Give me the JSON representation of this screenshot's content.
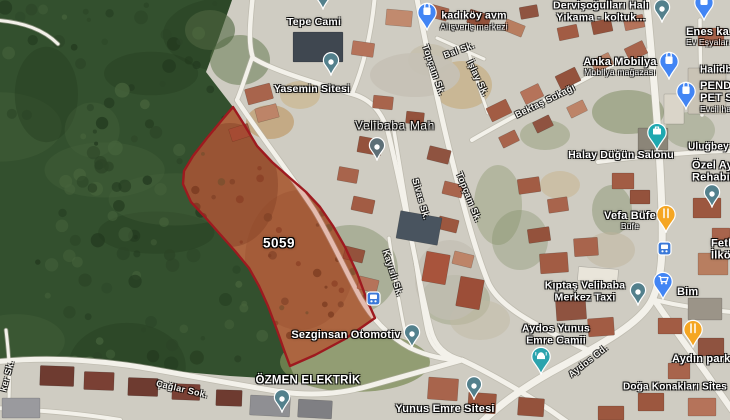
{
  "map": {
    "parcel": {
      "id_label": "5059",
      "outline_color": "#9e1a1f",
      "fill_color": "rgba(190,45,22,0.28)",
      "dirt_color": "#a57a51",
      "points": "233,107 222,120 207,138 193,156 184,171 183,184 191,202 204,216 219,233 235,251 249,268 259,286 268,306 277,330 284,350 290,366 315,355 345,339 375,318 367,300 357,273 345,247 333,226 320,207 306,192 290,178 272,162 257,146 245,126"
    },
    "colors": {
      "urban": "#cfccc2",
      "forest": "#33502e",
      "forest_dark": "#22381e",
      "forest_light": "#47643c",
      "road": "#f3f1ea",
      "road_casing": "#b3afa3"
    },
    "forest_points": "0,0 232,0 218,40 206,72 233,107 222,120 207,138 193,156 184,171 183,184 191,202 204,216 219,233 235,251 249,268 259,286 268,306 277,330 284,350 290,366 296,380 230,376 160,370 90,361 30,359 0,361",
    "roads": [
      {
        "d": "M646,-6 C652,60 660,140 662,215 C663,258 661,280 653,298 C643,322 602,344 562,366 C532,382 502,402 480,424",
        "w": 7
      },
      {
        "d": "M653,298 C668,320 688,348 704,370 C714,384 722,396 732,410",
        "w": 6
      },
      {
        "d": "M416,-6 C426,45 438,105 452,160 C464,208 475,250 488,282 C498,305 530,322 562,338 C576,345 588,350 598,355",
        "w": 5
      },
      {
        "d": "M253,-6 C250,22 248,44 253,58 C272,70 312,82 352,94 C371,99 382,112 388,132 C394,155 402,195 410,232 C416,262 423,300 431,330 C435,346 446,356 462,360",
        "w": 4.5
      },
      {
        "d": "M375,-6 C372,30 364,65 352,94",
        "w": 4
      },
      {
        "d": "M237,100 C260,135 289,172 314,210 C331,238 347,274 361,299 C371,317 388,336 410,348 C427,356 446,360 462,360",
        "w": 4.5
      },
      {
        "d": "M237,100 C242,88 247,72 252,58",
        "w": 4
      },
      {
        "d": "M393,125 C400,165 406,205 413,245 C417,272 421,300 427,330 C430,344 438,354 450,358",
        "w": 3.5
      },
      {
        "d": "M389,238 C394,272 399,305 406,336",
        "w": 3
      },
      {
        "d": "M472,140 C510,118 554,95 598,72 C618,62 636,54 652,49",
        "w": 4
      },
      {
        "d": "M437,38 C453,45 468,52 484,59",
        "w": 3
      },
      {
        "d": "M467,46 C473,68 480,91 488,113",
        "w": 3
      },
      {
        "d": "M-6,362 C40,357 90,359 140,367 C182,374 232,384 282,392 C312,396 341,394 369,386 C402,377 433,368 462,360",
        "w": 5
      },
      {
        "d": "M462,360 C492,374 522,392 550,410 C560,417 570,424 578,430",
        "w": 5
      },
      {
        "d": "M598,162 C628,158 658,155 688,153 C702,152 716,151 732,151",
        "w": 4
      },
      {
        "d": "M655,300 C680,306 706,310 732,312",
        "w": 4
      },
      {
        "d": "M-6,20 C24,22 44,30 58,44",
        "w": 3
      },
      {
        "d": "M-6,408 C40,410 84,414 120,420",
        "w": 4
      },
      {
        "d": "M700,20 C700,50 701,85 702,115",
        "w": 3.5
      },
      {
        "d": "M6,330 C9,355 11,380 8,412",
        "w": 3
      }
    ],
    "green_patches": [
      [
        355,
        362,
        75,
        30,
        "#7e8d58",
        0.75
      ],
      [
        350,
        270,
        48,
        45,
        "#74845a",
        0.4
      ],
      [
        300,
        300,
        30,
        40,
        "#6d7f52",
        0.45
      ],
      [
        498,
        205,
        24,
        40,
        "#7d8c5e",
        0.35
      ],
      [
        628,
        112,
        36,
        22,
        "#6f8152",
        0.45
      ],
      [
        545,
        135,
        25,
        15,
        "#78885a",
        0.35
      ],
      [
        455,
        300,
        35,
        25,
        "#7d8c5e",
        0.3
      ],
      [
        520,
        240,
        28,
        30,
        "#74845a",
        0.3
      ],
      [
        612,
        210,
        20,
        25,
        "#6d7f52",
        0.35
      ],
      [
        690,
        130,
        25,
        18,
        "#74845a",
        0.3
      ],
      [
        240,
        60,
        30,
        25,
        "#5d7347",
        0.5
      ],
      [
        210,
        30,
        25,
        20,
        "#4e6540",
        0.6
      ]
    ],
    "dirt_patches": [
      [
        462,
        85,
        30,
        24,
        "#c7b28a",
        0.8
      ],
      [
        270,
        122,
        24,
        17,
        "#c2a67e",
        0.9
      ],
      [
        300,
        95,
        20,
        14,
        "#cbb78f",
        0.7
      ],
      [
        430,
        60,
        22,
        16,
        "#c2b9a4",
        0.6
      ],
      [
        560,
        185,
        20,
        14,
        "#c7b28a",
        0.5
      ],
      [
        610,
        250,
        25,
        18,
        "#bfb49c",
        0.5
      ],
      [
        480,
        320,
        30,
        20,
        "#c2b9a4",
        0.5
      ],
      [
        415,
        75,
        45,
        22,
        "#c5c1b6",
        0.9
      ],
      [
        450,
        280,
        35,
        40,
        "#c2beb2",
        0.7
      ]
    ],
    "buildings": [
      [
        293,
        32,
        50,
        30,
        "#3f4750",
        0
      ],
      [
        246,
        86,
        26,
        16,
        "#a8644c",
        -15
      ],
      [
        256,
        106,
        22,
        14,
        "#bd8468",
        -15
      ],
      [
        230,
        126,
        20,
        13,
        "#9c573f",
        -18
      ],
      [
        352,
        42,
        22,
        14,
        "#b5735a",
        8
      ],
      [
        386,
        10,
        26,
        16,
        "#c18a6e",
        5
      ],
      [
        428,
        6,
        20,
        13,
        "#a8644c",
        15
      ],
      [
        468,
        12,
        22,
        14,
        "#94523c",
        18
      ],
      [
        504,
        22,
        20,
        12,
        "#b87e60",
        22
      ],
      [
        520,
        6,
        18,
        12,
        "#8f5340",
        -10
      ],
      [
        558,
        26,
        20,
        13,
        "#a25c44",
        -12
      ],
      [
        592,
        20,
        20,
        13,
        "#94523c",
        -12
      ],
      [
        624,
        16,
        20,
        13,
        "#b5735a",
        -12
      ],
      [
        488,
        103,
        22,
        15,
        "#a25c44",
        -26
      ],
      [
        522,
        87,
        20,
        14,
        "#b5735a",
        -26
      ],
      [
        557,
        71,
        22,
        15,
        "#94523c",
        -26
      ],
      [
        592,
        56,
        20,
        13,
        "#bd8468",
        -26
      ],
      [
        626,
        44,
        20,
        14,
        "#a8644c",
        -26
      ],
      [
        500,
        133,
        18,
        12,
        "#a8644c",
        -26
      ],
      [
        534,
        118,
        18,
        12,
        "#8f5340",
        -26
      ],
      [
        568,
        103,
        18,
        12,
        "#bd8468",
        -26
      ],
      [
        358,
        138,
        24,
        16,
        "#94523c",
        10
      ],
      [
        338,
        168,
        20,
        14,
        "#a8644c",
        10
      ],
      [
        352,
        198,
        22,
        14,
        "#a25c44",
        12
      ],
      [
        344,
        248,
        20,
        13,
        "#94523c",
        14
      ],
      [
        358,
        278,
        20,
        13,
        "#b5735a",
        14
      ],
      [
        428,
        148,
        22,
        14,
        "#8f5340",
        14
      ],
      [
        443,
        183,
        20,
        13,
        "#a8644c",
        14
      ],
      [
        438,
        218,
        20,
        13,
        "#9c573f",
        14
      ],
      [
        453,
        253,
        20,
        13,
        "#bd8468",
        14
      ],
      [
        398,
        214,
        42,
        28,
        "#49545f",
        10
      ],
      [
        518,
        178,
        22,
        15,
        "#a25c44",
        -8
      ],
      [
        548,
        198,
        20,
        14,
        "#a8644c",
        -8
      ],
      [
        528,
        228,
        22,
        14,
        "#94523c",
        -8
      ],
      [
        540,
        253,
        28,
        20,
        "#a25c44",
        -4
      ],
      [
        574,
        238,
        24,
        18,
        "#a8644c",
        -4
      ],
      [
        578,
        268,
        40,
        14,
        "#e9e5da",
        4
      ],
      [
        688,
        68,
        38,
        46,
        "#c9c3b5",
        0
      ],
      [
        664,
        94,
        20,
        30,
        "#dad5c9",
        0
      ],
      [
        698,
        28,
        26,
        18,
        "#a8644c",
        0
      ],
      [
        638,
        128,
        30,
        22,
        "#8b8578",
        0
      ],
      [
        612,
        173,
        22,
        16,
        "#a25c44",
        0
      ],
      [
        630,
        190,
        20,
        14,
        "#94523c",
        0
      ],
      [
        693,
        198,
        28,
        20,
        "#9c573f",
        0
      ],
      [
        712,
        228,
        18,
        14,
        "#a8644c",
        0
      ],
      [
        698,
        253,
        30,
        22,
        "#b87e60",
        0
      ],
      [
        688,
        298,
        34,
        22,
        "#9b9488",
        0
      ],
      [
        658,
        318,
        24,
        16,
        "#a25c44",
        0
      ],
      [
        698,
        338,
        26,
        18,
        "#8f5340",
        0
      ],
      [
        668,
        363,
        22,
        16,
        "#a8644c",
        0
      ],
      [
        638,
        393,
        26,
        18,
        "#9c573f",
        0
      ],
      [
        688,
        398,
        28,
        18,
        "#b5735a",
        0
      ],
      [
        556,
        298,
        30,
        22,
        "#8f5340",
        -4
      ],
      [
        588,
        318,
        26,
        18,
        "#a25c44",
        -4
      ],
      [
        424,
        253,
        24,
        30,
        "#a8543c",
        10
      ],
      [
        458,
        278,
        24,
        30,
        "#9c4e38",
        10
      ],
      [
        428,
        378,
        30,
        22,
        "#a8644c",
        4
      ],
      [
        468,
        393,
        28,
        20,
        "#9c573f",
        4
      ],
      [
        518,
        398,
        26,
        18,
        "#94523c",
        4
      ],
      [
        40,
        366,
        34,
        20,
        "#6e3b30",
        2
      ],
      [
        84,
        372,
        30,
        18,
        "#7a4034",
        2
      ],
      [
        128,
        378,
        30,
        18,
        "#6e3b30",
        2
      ],
      [
        172,
        384,
        28,
        16,
        "#7a4034",
        2
      ],
      [
        216,
        390,
        26,
        16,
        "#6e3b30",
        2
      ],
      [
        250,
        396,
        40,
        20,
        "#8f8f93",
        3
      ],
      [
        298,
        400,
        34,
        18,
        "#7f7f83",
        3
      ],
      [
        2,
        398,
        38,
        20,
        "#9a9a9e",
        0
      ],
      [
        598,
        406,
        26,
        14,
        "#9c573f",
        0
      ],
      [
        373,
        96,
        20,
        13,
        "#a8644c",
        6
      ],
      [
        406,
        112,
        18,
        12,
        "#94523c",
        6
      ]
    ],
    "poi_labels": [
      {
        "name": "tepe-cami",
        "lines": [
          "Tepe Cami"
        ],
        "x": 314,
        "y": 23,
        "anchor": "center",
        "size": 10.5
      },
      {
        "name": "kadikoy-avm",
        "lines": [
          "kadıköy avm",
          "Alışveriş merkezi"
        ],
        "x": 474,
        "y": 21,
        "anchor": "center",
        "size": 10.5,
        "sub": 1
      },
      {
        "name": "dervisogullari-hali-yikama",
        "lines": [
          "Dervişoğulları Halı",
          "Yıkama - koltuk..."
        ],
        "x": 601,
        "y": 12,
        "anchor": "center",
        "size": 10.5
      },
      {
        "name": "enes-ev-esyalari",
        "lines": [
          "Enes ka",
          "Ev Eşyaları"
        ],
        "x": 686,
        "y": 37,
        "anchor": "left",
        "size": 11,
        "sub": 1
      },
      {
        "name": "yasemin-sitesi",
        "lines": [
          "Yasemin Sitesi"
        ],
        "x": 312,
        "y": 90,
        "anchor": "center",
        "size": 10.5
      },
      {
        "name": "anka-mobilya",
        "lines": [
          "Anka Mobilya",
          "Mobilya mağazası"
        ],
        "x": 620,
        "y": 67,
        "anchor": "center",
        "size": 11,
        "sub": 1
      },
      {
        "name": "halidbu",
        "lines": [
          "Halidbü"
        ],
        "x": 700,
        "y": 70,
        "anchor": "left",
        "size": 10
      },
      {
        "name": "pendik-pet-shop",
        "lines": [
          "PEND",
          "PET S",
          "Evcil ha"
        ],
        "x": 700,
        "y": 97,
        "anchor": "left",
        "size": 11,
        "sub": 2
      },
      {
        "name": "velibaba-mah",
        "lines": [
          "Velibaba Mah"
        ],
        "x": 395,
        "y": 126,
        "anchor": "center",
        "size": 12,
        "cls": "district"
      },
      {
        "name": "halay-dugun-salonu",
        "lines": [
          "Halay Düğün Salonu"
        ],
        "x": 621,
        "y": 156,
        "anchor": "center",
        "size": 10.5
      },
      {
        "name": "ulugbey",
        "lines": [
          "Uluğbey"
        ],
        "x": 688,
        "y": 147,
        "anchor": "left",
        "size": 10
      },
      {
        "name": "ozel-ay-rehabilitasyon",
        "lines": [
          "Özel Ay",
          "Rehabi"
        ],
        "x": 692,
        "y": 172,
        "anchor": "left",
        "size": 11
      },
      {
        "name": "vefa-bufe",
        "lines": [
          "Vefa Büfe",
          "Büfe"
        ],
        "x": 630,
        "y": 221,
        "anchor": "center",
        "size": 11,
        "sub": 1
      },
      {
        "name": "fethi-ilkogretim",
        "lines": [
          "Feth",
          "İlkö"
        ],
        "x": 711,
        "y": 250,
        "anchor": "left",
        "size": 11
      },
      {
        "name": "kiptas-velibaba-merkez-taxi",
        "lines": [
          "Kıptaş Velibaba",
          "Merkez Taxi"
        ],
        "x": 585,
        "y": 292,
        "anchor": "center",
        "size": 10.5
      },
      {
        "name": "bim",
        "lines": [
          "Bim"
        ],
        "x": 677,
        "y": 292,
        "anchor": "left",
        "size": 11
      },
      {
        "name": "sezginsan-otomotiv",
        "lines": [
          "Sezginsan Otomotiv"
        ],
        "x": 346,
        "y": 335,
        "anchor": "center",
        "size": 11
      },
      {
        "name": "aydos-yunus-emre-camii",
        "lines": [
          "Aydos Yunus",
          "Emre Camii"
        ],
        "x": 556,
        "y": 335,
        "anchor": "center",
        "size": 10.5
      },
      {
        "name": "aydin-park",
        "lines": [
          "Aydın park"
        ],
        "x": 672,
        "y": 359,
        "anchor": "left",
        "size": 11
      },
      {
        "name": "ozmen-elektrik",
        "lines": [
          "ÖZMEN ELEKTRİK"
        ],
        "x": 308,
        "y": 381,
        "anchor": "center",
        "size": 11.5
      },
      {
        "name": "doga-konaklari-sitesi",
        "lines": [
          "Doğa Konakları Sites"
        ],
        "x": 623,
        "y": 387,
        "anchor": "left",
        "size": 10
      },
      {
        "name": "yunus-emre-sitesi",
        "lines": [
          "Yunus Emre Sitesi"
        ],
        "x": 445,
        "y": 409,
        "anchor": "center",
        "size": 11
      }
    ],
    "street_labels": [
      {
        "text": "Topçam Sk.",
        "x": 434,
        "y": 70,
        "rotate": 71
      },
      {
        "text": "Bal Sk.",
        "x": 459,
        "y": 50,
        "rotate": -20
      },
      {
        "text": "İşlay Sk.",
        "x": 478,
        "y": 78,
        "rotate": 64
      },
      {
        "text": "Bektaş Sokağı",
        "x": 545,
        "y": 101,
        "rotate": -26
      },
      {
        "text": "Topçam Sk.",
        "x": 469,
        "y": 197,
        "rotate": 68
      },
      {
        "text": "Sivas Sk.",
        "x": 421,
        "y": 199,
        "rotate": 74
      },
      {
        "text": "Kayıslı Sk.",
        "x": 393,
        "y": 273,
        "rotate": 72
      },
      {
        "text": "Çağlar Sok.",
        "x": 182,
        "y": 389,
        "rotate": 13
      },
      {
        "text": "ker Sk.",
        "x": 7,
        "y": 376,
        "rotate": -75
      },
      {
        "text": "Aydos Cd.",
        "x": 588,
        "y": 361,
        "rotate": -38
      }
    ],
    "pins": [
      {
        "type": "place",
        "x": 323,
        "y": 9,
        "color": "#53808c"
      },
      {
        "type": "shopping",
        "x": 427,
        "y": 30,
        "color": "#4285f4"
      },
      {
        "type": "place",
        "x": 662,
        "y": 22,
        "color": "#53808c"
      },
      {
        "type": "shopping",
        "x": 704,
        "y": 20,
        "color": "#4285f4"
      },
      {
        "type": "place",
        "x": 331,
        "y": 75,
        "color": "#53808c"
      },
      {
        "type": "shopping",
        "x": 669,
        "y": 79,
        "color": "#4285f4"
      },
      {
        "type": "shopping",
        "x": 686,
        "y": 109,
        "color": "#4285f4"
      },
      {
        "type": "neighborhood",
        "x": 377,
        "y": 160,
        "color": "#5d6f77"
      },
      {
        "type": "briefcase",
        "x": 657,
        "y": 150,
        "color": "#1fa8b0"
      },
      {
        "type": "place",
        "x": 712,
        "y": 207,
        "color": "#53808c"
      },
      {
        "type": "food",
        "x": 666,
        "y": 232,
        "color": "#f5a623"
      },
      {
        "type": "place",
        "x": 638,
        "y": 305,
        "color": "#53808c"
      },
      {
        "type": "cart",
        "x": 663,
        "y": 299,
        "color": "#4285f4"
      },
      {
        "type": "place",
        "x": 412,
        "y": 347,
        "color": "#53808c"
      },
      {
        "type": "mosque",
        "x": 541,
        "y": 374,
        "color": "#2ba3ad"
      },
      {
        "type": "food",
        "x": 693,
        "y": 347,
        "color": "#f5a623"
      },
      {
        "type": "place",
        "x": 282,
        "y": 412,
        "color": "#53808c"
      },
      {
        "type": "place",
        "x": 474,
        "y": 399,
        "color": "#53808c"
      },
      {
        "type": "transit",
        "x": 664,
        "y": 248,
        "color": "#3a79d9"
      },
      {
        "type": "transit",
        "x": 373,
        "y": 298,
        "color": "#3a79d9"
      }
    ]
  }
}
